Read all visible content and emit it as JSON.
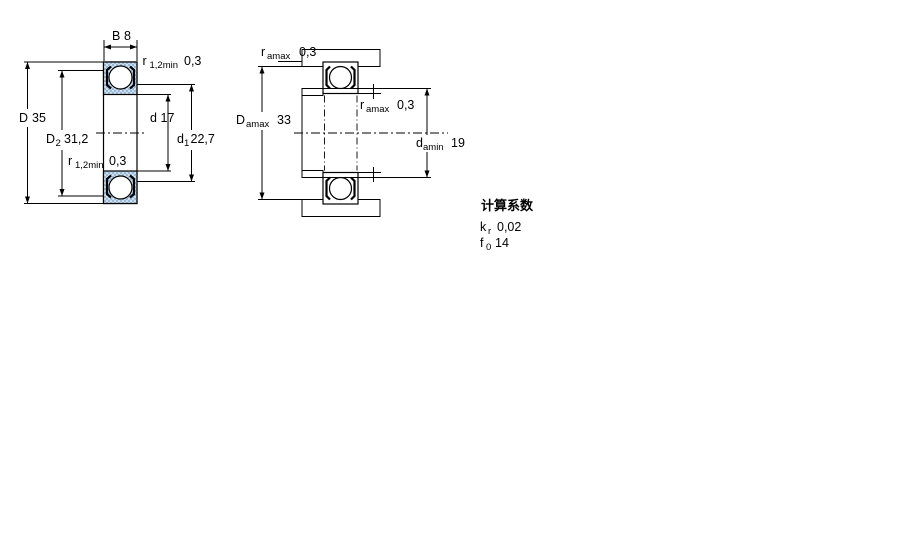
{
  "colors": {
    "hatch_dark": "#9ab9d5",
    "hatch_light": "#cddfec",
    "line": "#000000",
    "background": "#ffffff"
  },
  "left_view": {
    "description": "bearing cross section with boundary dimensions",
    "labels": {
      "B": {
        "sym": "B",
        "sub": "",
        "val": "8"
      },
      "r_top": {
        "sym": "r",
        "sub": "1,2min",
        "val": "0,3"
      },
      "D": {
        "sym": "D",
        "sub": "",
        "val": "35"
      },
      "D2": {
        "sym": "D",
        "sub": "2",
        "val": "31,2"
      },
      "d": {
        "sym": "d",
        "sub": "",
        "val": "17"
      },
      "d1": {
        "sym": "d",
        "sub": "1",
        "val": "22,7"
      },
      "r_bottom": {
        "sym": "r",
        "sub": "1,2min",
        "val": "0,3"
      }
    }
  },
  "right_view": {
    "description": "mounted bearing abutment dimensions",
    "labels": {
      "r_a_top": {
        "sym": "r",
        "sub": "amax",
        "val": "0,3"
      },
      "D_a": {
        "sym": "D",
        "sub": "amax",
        "val": "33"
      },
      "r_a_mid": {
        "sym": "r",
        "sub": "amax",
        "val": "0,3"
      },
      "d_a": {
        "sym": "d",
        "sub": "amin",
        "val": "19"
      }
    }
  },
  "calculation_factors": {
    "title": "计算系数",
    "rows": [
      {
        "sym": "k",
        "sub": "r",
        "val": "0,02"
      },
      {
        "sym": "f",
        "sub": "0",
        "val": "14"
      }
    ]
  }
}
